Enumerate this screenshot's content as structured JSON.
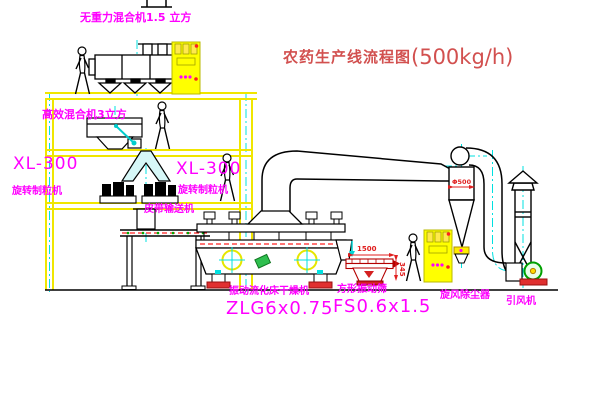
{
  "title": {
    "cn": "农药生产线流程图",
    "capacity": "(500kg/h)"
  },
  "labels": {
    "top_mixer": "无重力混合机1.5 立方",
    "high_eff_mixer": "高效混合机3立方",
    "left_model": "XL-300",
    "left_name": "旋转制粒机",
    "mid_model": "XL-300",
    "mid_name": "旋转制粒机",
    "belt_conveyor": "皮带输送机",
    "dryer_name": "振动流化床干燥机",
    "dryer_model": "ZLG6x0.75",
    "sieve_name": "方形振动筛",
    "sieve_model": "FS0.6x1.5",
    "cyclone": "旋风除尘器",
    "fan": "引风机"
  },
  "dimensions": {
    "sieve_width": "1500",
    "sieve_height": "345",
    "cyclone_dia": "Φ500"
  },
  "colors": {
    "background": "#ffffff",
    "structure_yellow": "#f0e600",
    "centerline_cyan": "#00e0e0",
    "label_magenta": "#ff00ff",
    "title_red": "#d2504f",
    "dimension_red": "#e02020",
    "outline_black": "#000000",
    "sieve_darkred": "#b40000",
    "fan_green": "#00a000"
  }
}
